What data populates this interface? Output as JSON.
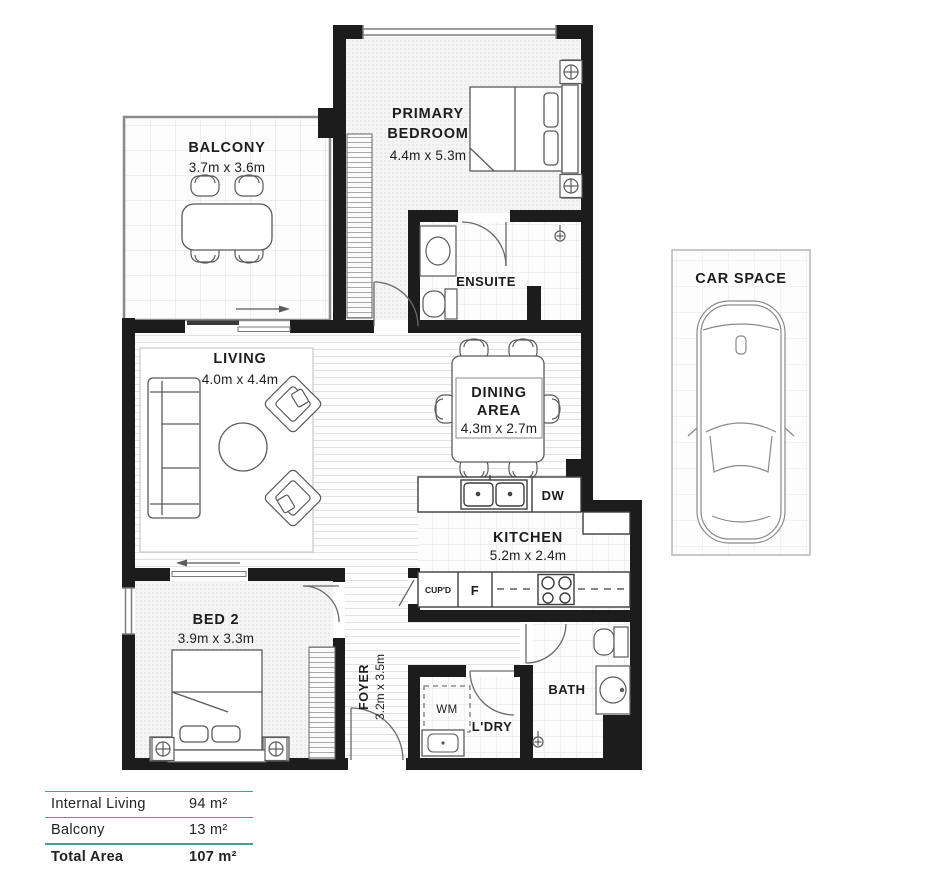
{
  "plan": {
    "rooms": {
      "balcony": {
        "name": "BALCONY",
        "dims": "3.7m x 3.6m"
      },
      "primary_bedroom": {
        "name_line1": "PRIMARY",
        "name_line2": "BEDROOM",
        "dims": "4.4m x 5.3m"
      },
      "ensuite": {
        "name": "ENSUITE"
      },
      "living": {
        "name": "LIVING",
        "dims": "4.0m x 4.4m"
      },
      "dining": {
        "name_line1": "DINING",
        "name_line2": "AREA",
        "dims": "4.3m x 2.7m"
      },
      "kitchen": {
        "name": "KITCHEN",
        "dims": "5.2m x 2.4m"
      },
      "bed2": {
        "name": "BED 2",
        "dims": "3.9m x 3.3m"
      },
      "foyer": {
        "name": "FOYER",
        "dims": "3.2m x 3.5m"
      },
      "bath": {
        "name": "BATH"
      },
      "laundry": {
        "name": "L'DRY"
      },
      "car_space": {
        "name": "CAR SPACE"
      }
    },
    "appliances": {
      "washing_machine": "WM",
      "dishwasher": "DW",
      "fridge": "F",
      "cupboard": "CUP'D"
    }
  },
  "legend": {
    "rows": [
      {
        "label": "Internal Living",
        "value": "94 m²"
      },
      {
        "label": "Balcony",
        "value": "13 m²"
      },
      {
        "label": "Total Area",
        "value": "107 m²"
      }
    ]
  },
  "colors": {
    "wall": "#1c1c1c",
    "accent_line": "#4a9e92"
  }
}
